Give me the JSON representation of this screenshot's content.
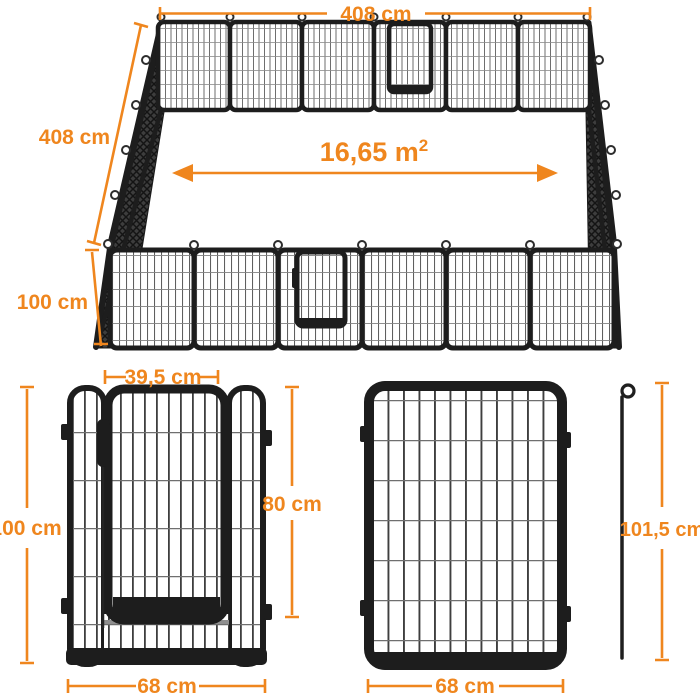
{
  "colors": {
    "accent": "#EF861E",
    "frame": "#1D1D1D"
  },
  "overview": {
    "top_width": "408 cm",
    "side_depth": "408 cm",
    "front_height": "100 cm",
    "area_value": "16,65 m",
    "area_exponent": "2"
  },
  "door_panel": {
    "door_width": "39,5 cm",
    "panel_height": "100 cm",
    "door_height": "80 cm",
    "panel_width": "68 cm"
  },
  "mesh_panel": {
    "panel_width": "68 cm"
  },
  "ground_stake": {
    "length": "101,5 cm"
  }
}
